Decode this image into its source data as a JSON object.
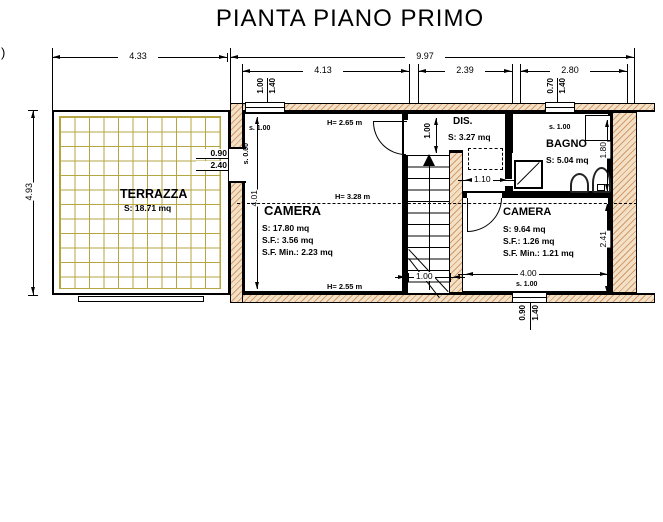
{
  "title": "PIANTA PIANO PRIMO",
  "stray": ")",
  "dims": {
    "terrace_w": "4.33",
    "building_w": "9.97",
    "room1_w": "4.13",
    "mid_w": "2.39",
    "room2_w": "2.80",
    "left_h": "4.93",
    "camera1_h": "4.01",
    "camera2_w": "4.00",
    "camera2_h": "2.41",
    "bagno_h": "1.80",
    "dis_w": "1.10",
    "stairs_w": "1.00",
    "landing_d": "1.00"
  },
  "openings": {
    "win1_w": "1.00",
    "win1_h": "1.40",
    "win2_w": "0.70",
    "win2_h": "1.40",
    "win3_w": "0.90",
    "win3_h": "1.40",
    "terrace_door_w": "0.90",
    "terrace_door_h": "2.40"
  },
  "sills": {
    "camera1_window": "s. 1.00",
    "camera1_door": "s. 0.00",
    "bagno_window": "s. 1.00",
    "camera2_window": "s. 1.00"
  },
  "rooms": {
    "terrazza": {
      "name": "TERRAZZA",
      "area": "S: 18.71 mq"
    },
    "camera1": {
      "name": "CAMERA",
      "area": "S: 17.80 mq",
      "sf": "S.F.: 3.56 mq",
      "sf_min": "S.F. Min.: 2.23 mq",
      "h_top": "H= 2.65 m",
      "h_ridge": "H= 3.28 m",
      "h_bottom": "H= 2.55 m"
    },
    "dis": {
      "name": "DIS.",
      "area": "S: 3.27 mq"
    },
    "bagno": {
      "name": "BAGNO",
      "area": "S: 5.04 mq"
    },
    "camera2": {
      "name": "CAMERA",
      "area": "S: 9.64 mq",
      "sf": "S.F.: 1.26 mq",
      "sf_min": "S.F. Min.: 1.21 mq"
    }
  },
  "colors": {
    "wall_hatch": "#d59b6a",
    "wall_fill": "#f3e1c7",
    "terrace_grid": "#b5a642",
    "line": "#000000"
  }
}
